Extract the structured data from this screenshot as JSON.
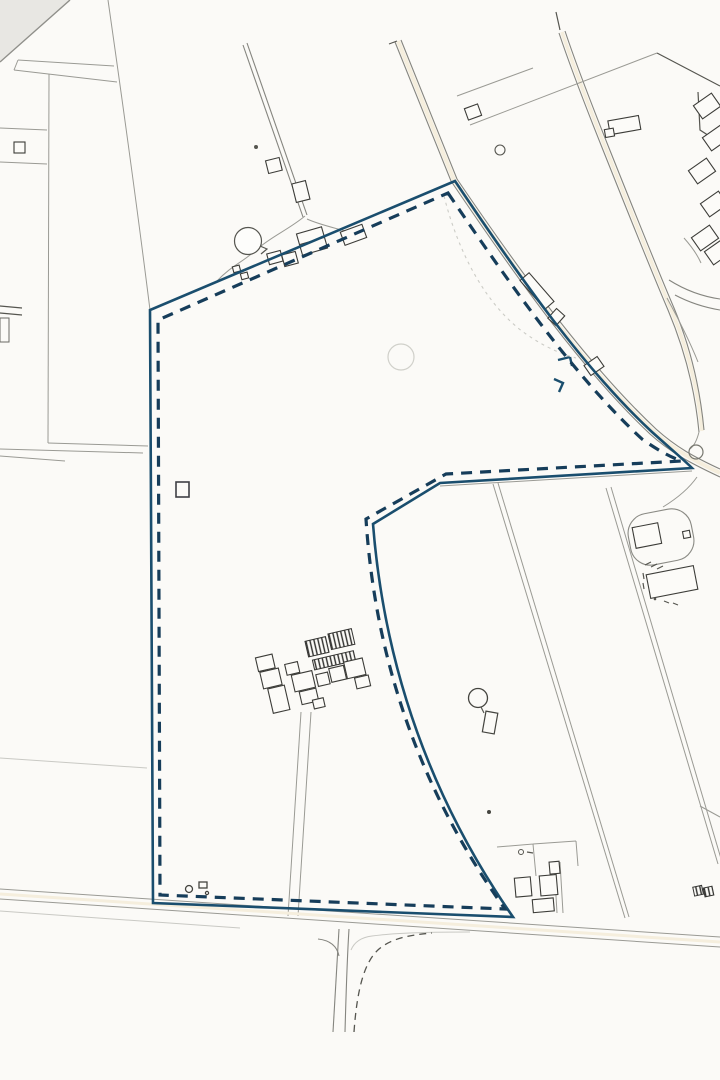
{
  "map": {
    "background": "#fbfaf7",
    "paper_shadow": "#e8e7e3",
    "boundary": {
      "solid_color": "#1a4e6e",
      "dashed_color": "#163d5a"
    },
    "road_color": "#85857f",
    "field_line_color": "#9a9a94",
    "building_color": "#3c3c38",
    "features": [
      "site-boundary-solid-line",
      "site-boundary-dashed-line",
      "north-lane",
      "north-farmstead-with-pond",
      "east-road-with-junction",
      "northeast-farm-buildings",
      "central-farmstead-with-greenhouses",
      "water-tower",
      "driveway-loop",
      "southeast-buildings",
      "south-road-t-junction",
      "field-boundaries"
    ]
  }
}
